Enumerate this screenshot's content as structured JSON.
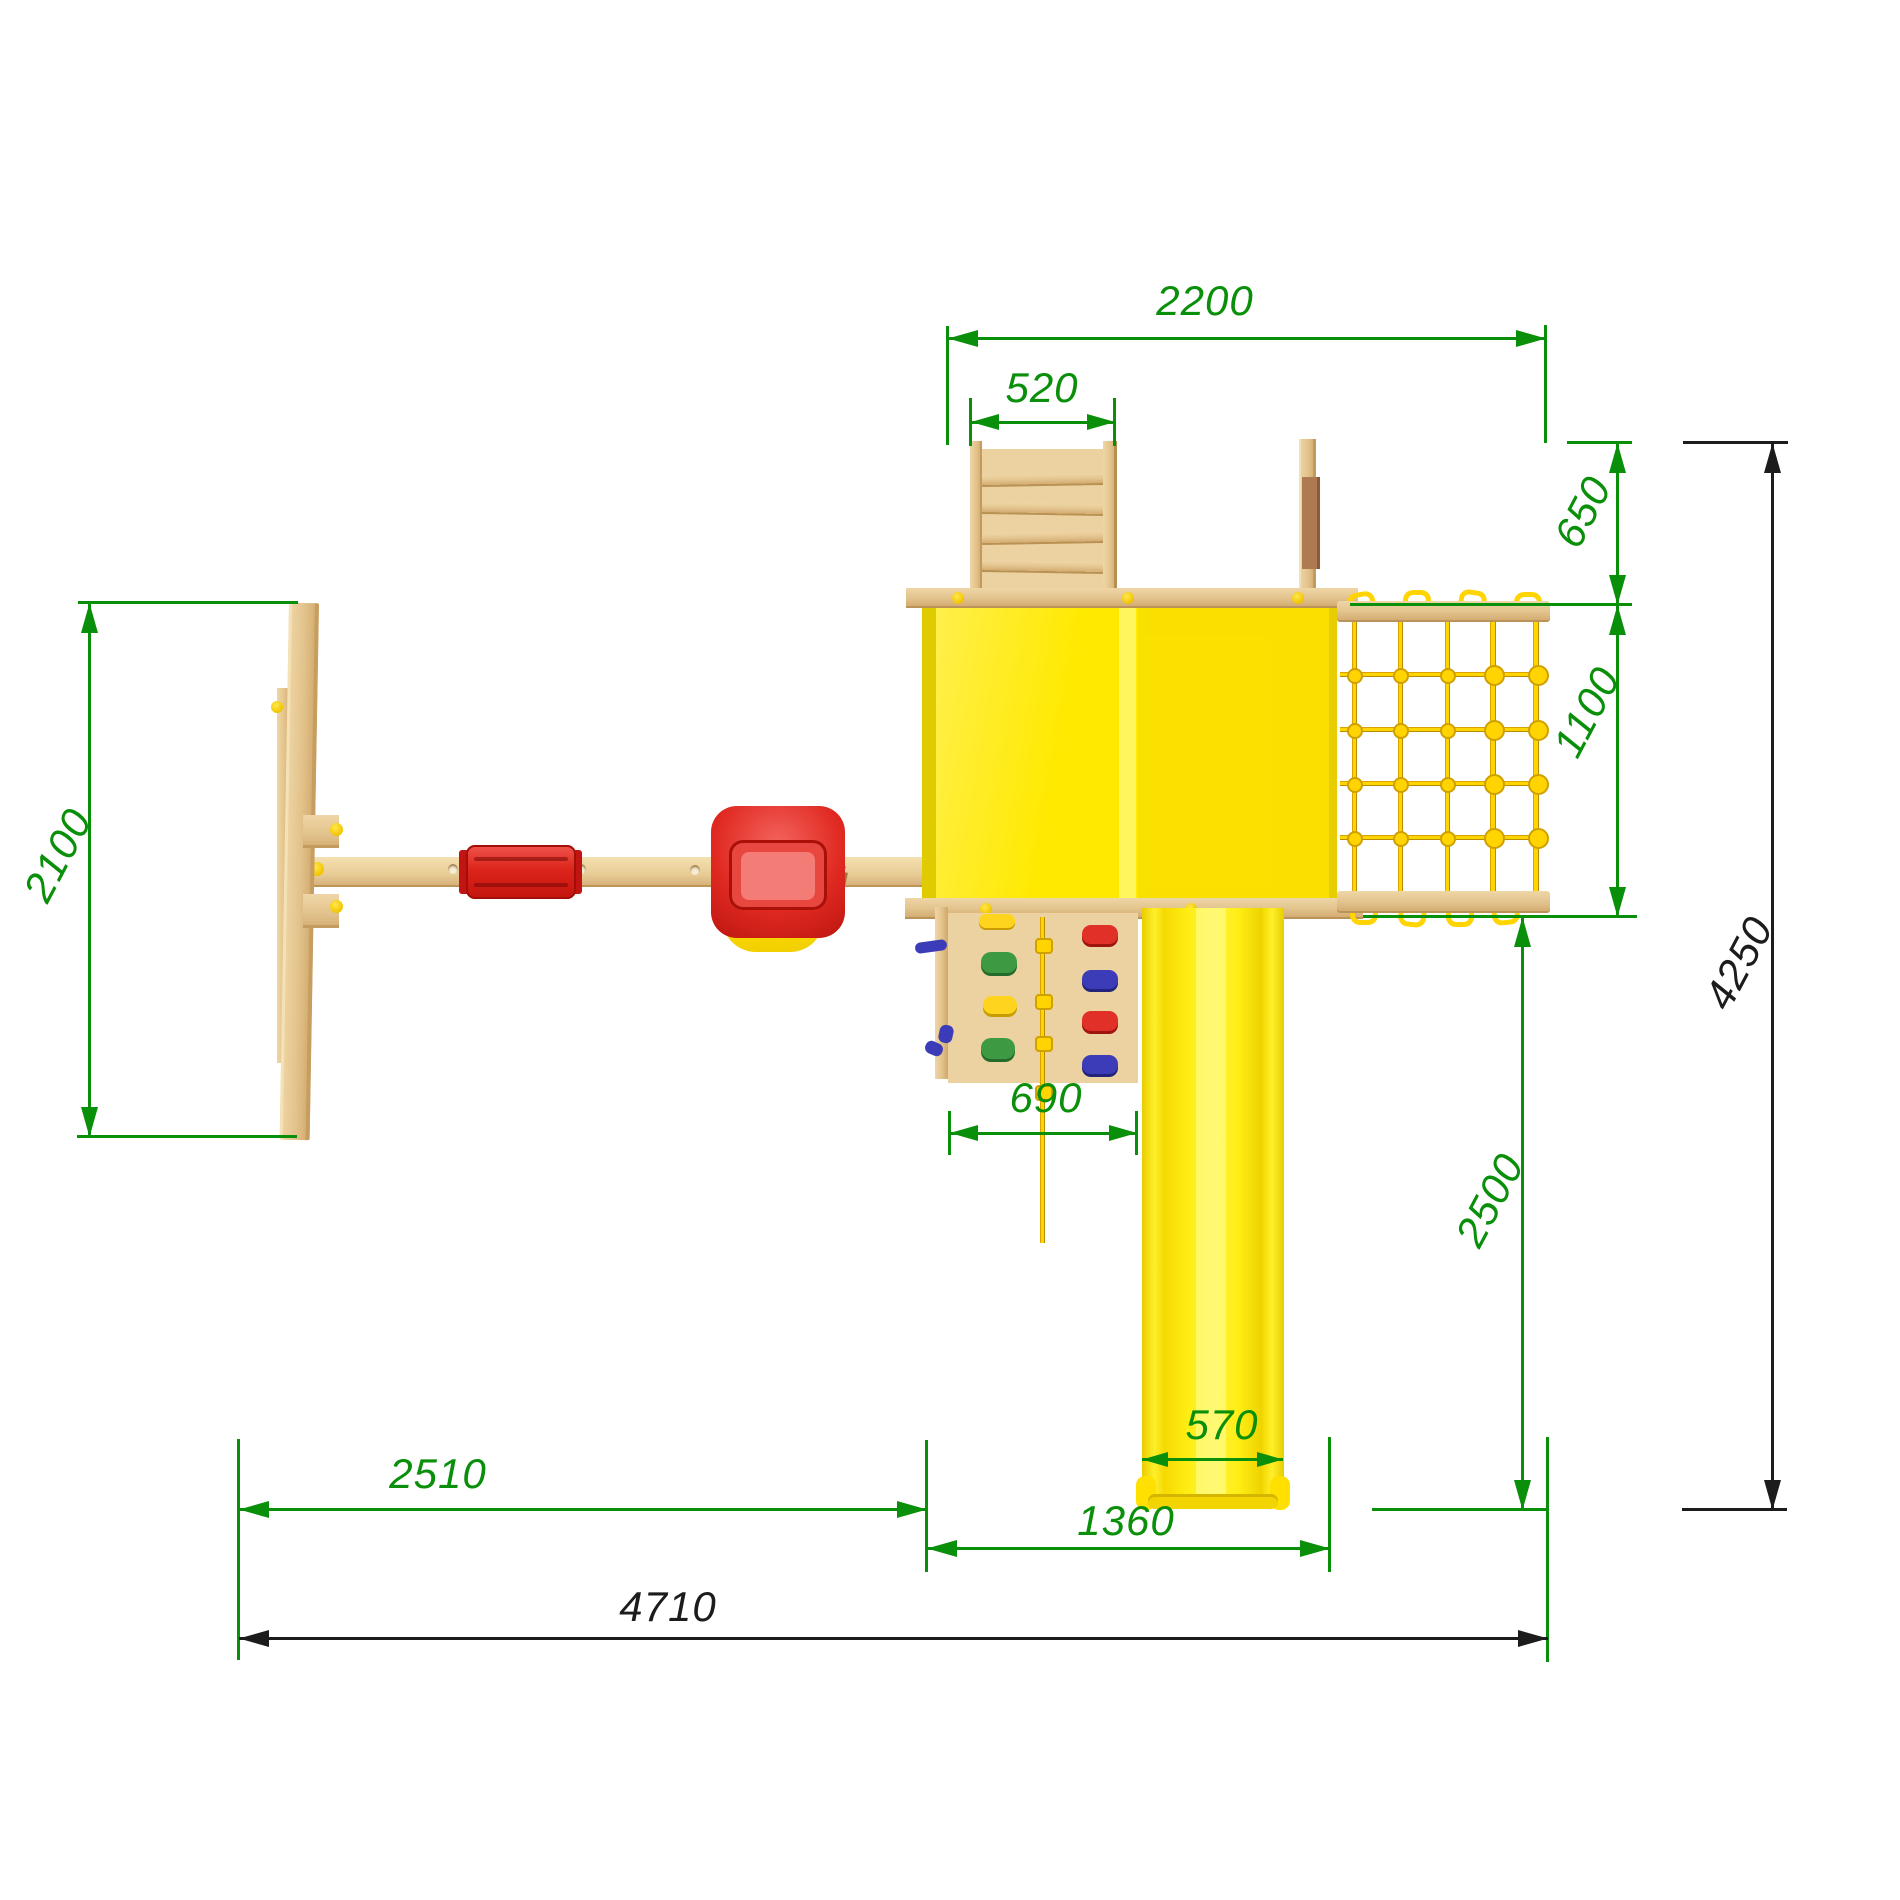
{
  "drawing": {
    "title": "playground-set-top-view-plan",
    "dimension_color_green": "#0a8f0a",
    "dimension_color_black": "#1c1c1c",
    "roof_color": "#ffe900",
    "wood_color": "#ecd1a1",
    "rope_color": "#fed500",
    "seat_color": "#da251c"
  },
  "dims": {
    "tower_span": "2200",
    "ladder_width": "520",
    "balcony_depth": "650",
    "net_depth": "1100",
    "swing_frame_depth": "2100",
    "climb_wall_width": "690",
    "slide_run_depth": "2500",
    "slide_width": "570",
    "swing_section_width": "2510",
    "slide_section_width": "1360",
    "overall_width": "4710",
    "overall_depth": "4250"
  }
}
